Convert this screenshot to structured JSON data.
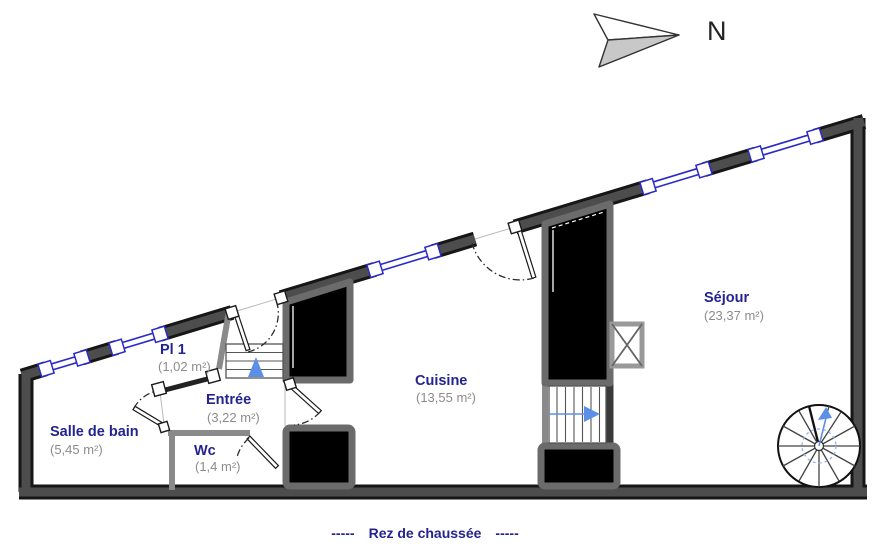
{
  "compass": {
    "label": "N"
  },
  "caption": {
    "dashes_left": "-----",
    "label": "Rez de chaussée",
    "dashes_right": "-----"
  },
  "rooms": [
    {
      "name": "Salle de bain",
      "area": "(5,45 m²)"
    },
    {
      "name": "Pl 1",
      "area": "(1,02 m²)"
    },
    {
      "name": "Entrée",
      "area": "(3,22 m²)"
    },
    {
      "name": "Wc",
      "area": "(1,4 m²)"
    },
    {
      "name": "Cuisine",
      "area": "(13,55 m²)"
    },
    {
      "name": "Séjour",
      "area": "(23,37 m²)"
    }
  ],
  "colors": {
    "room_label": "#242490",
    "area_label": "#8c8c8c",
    "window": "#2a2ac8",
    "stair_arrow": "#5b8fe8",
    "wall": "#4d4d4d",
    "caption": "#242490"
  }
}
